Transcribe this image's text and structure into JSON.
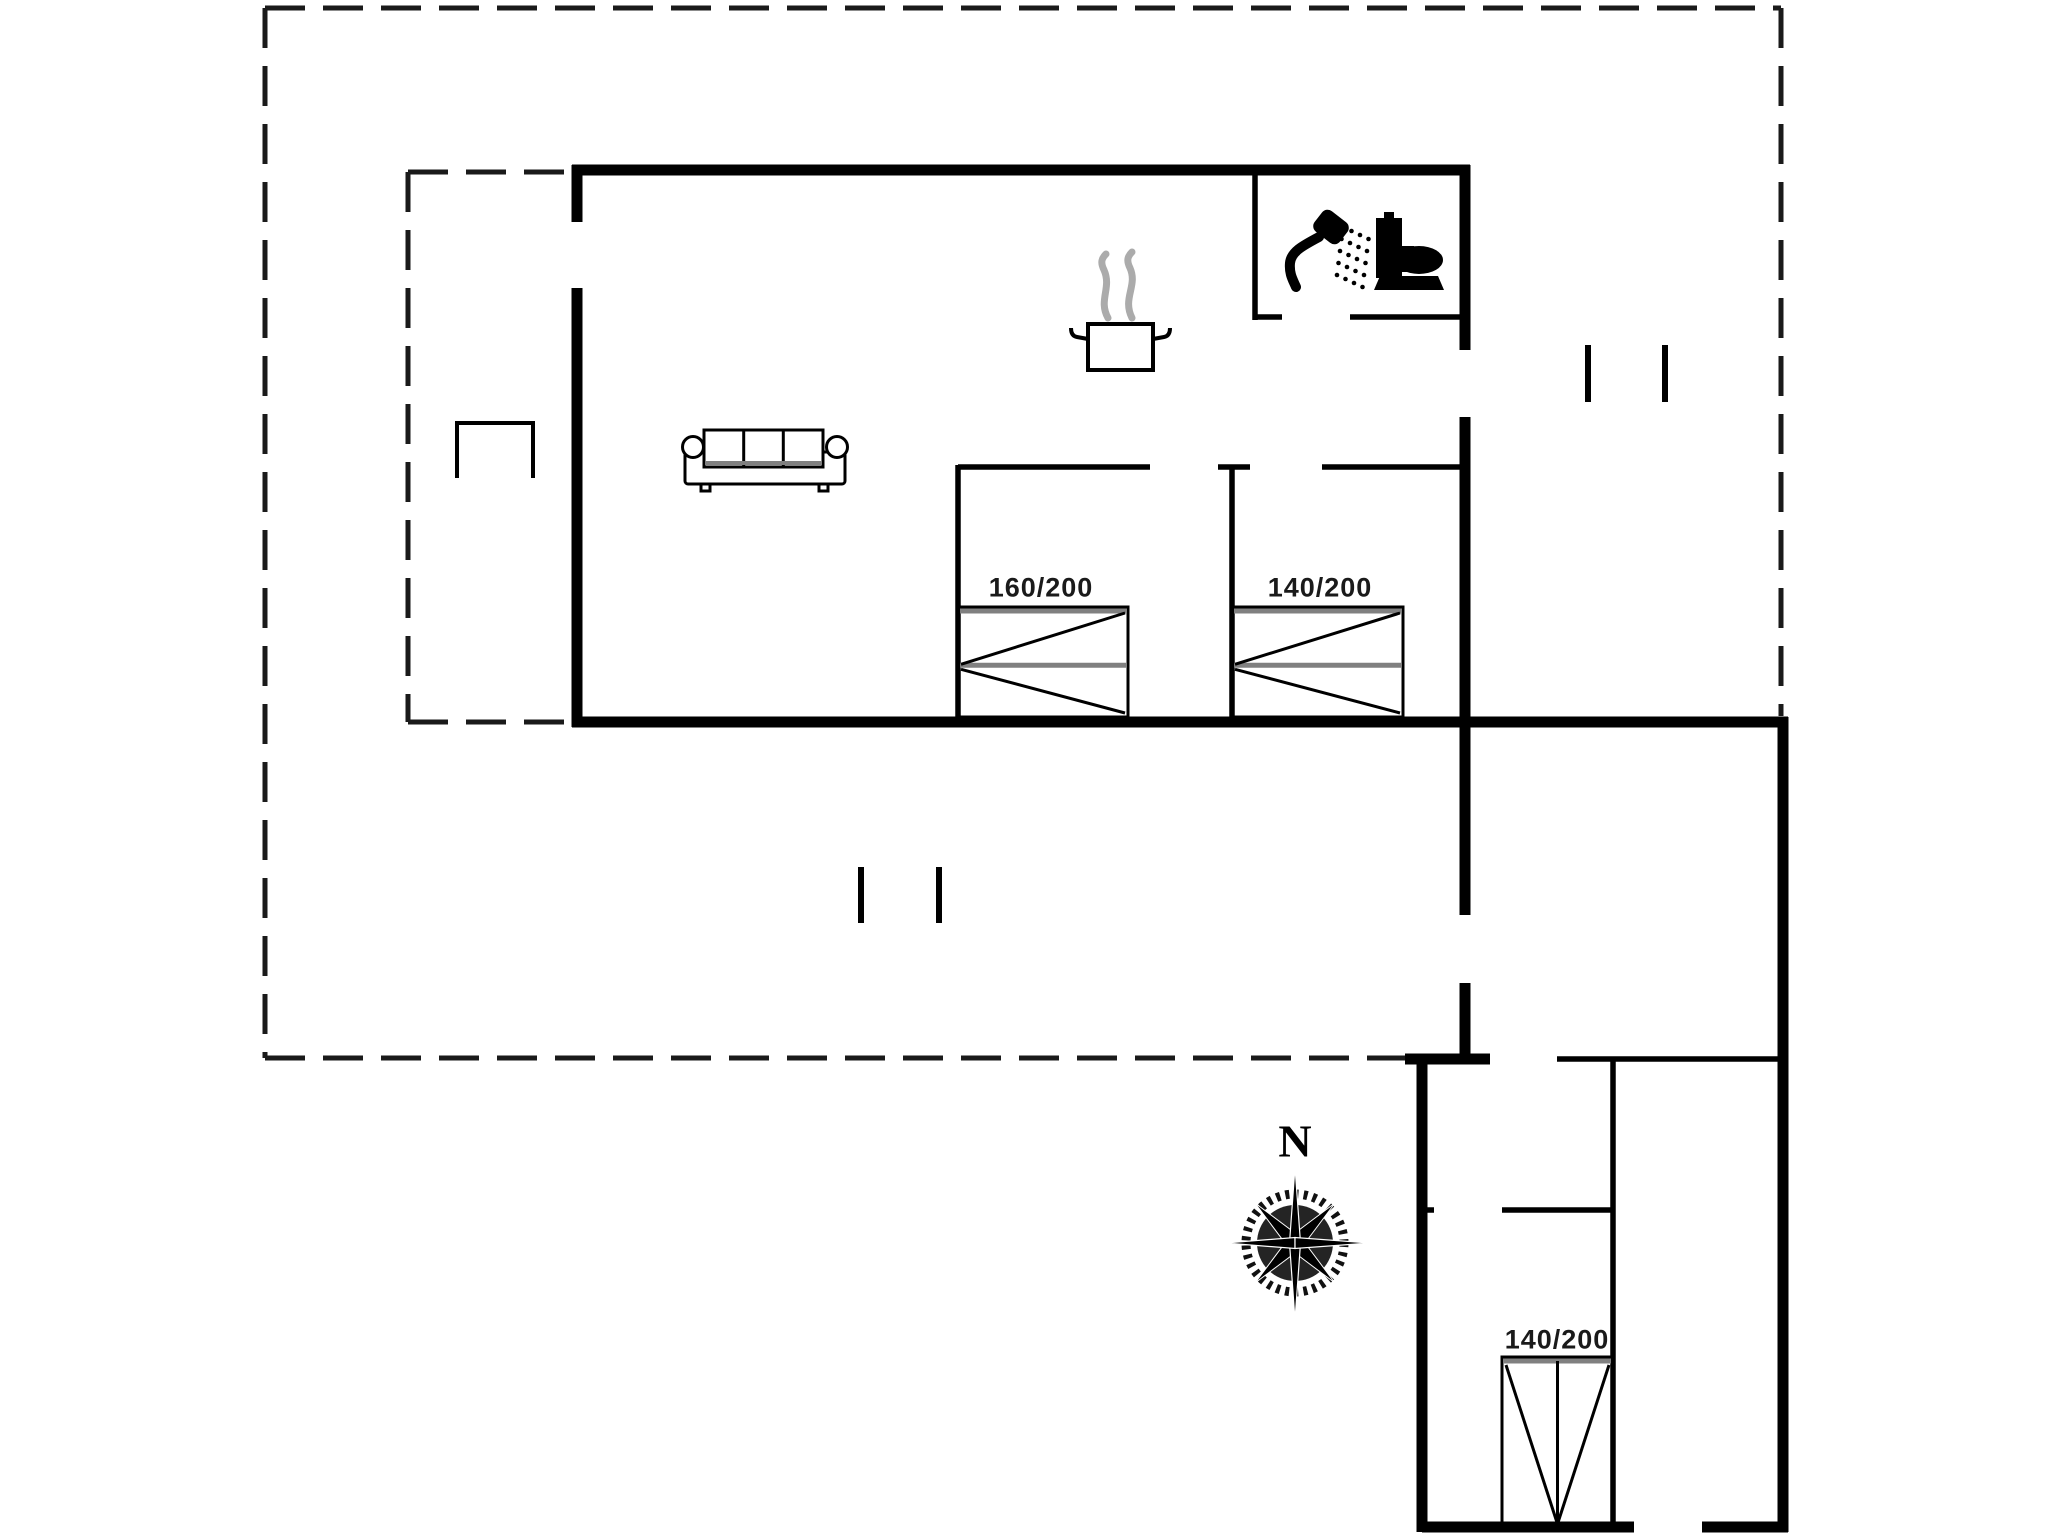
{
  "page": {
    "background": "#ffffff",
    "width": 2048,
    "height": 1536
  },
  "colors": {
    "wall": "#000000",
    "partition": "#000000",
    "boundary": "#1a1a1a",
    "bed_gray": "#808080",
    "steam": "#ababab",
    "icon": "#000000",
    "label_text": "#1a1a1a"
  },
  "floorplan": {
    "outer_boundary_dashed": [
      [
        265,
        8,
        1781,
        8
      ],
      [
        265,
        8,
        265,
        1058
      ],
      [
        265,
        1058,
        1408,
        1058
      ],
      [
        1781,
        8,
        1781,
        716
      ]
    ],
    "inner_terrace_dashed": [
      [
        408,
        172,
        570,
        172
      ],
      [
        408,
        172,
        408,
        722
      ],
      [
        408,
        722,
        574,
        722
      ]
    ],
    "walls_thick": [
      [
        572,
        170,
        1470,
        170
      ],
      [
        577,
        165,
        577,
        222
      ],
      [
        577,
        288,
        577,
        727
      ],
      [
        572,
        722,
        1788,
        722
      ],
      [
        1465,
        165,
        1465,
        350
      ],
      [
        1465,
        417,
        1465,
        915
      ],
      [
        1465,
        983,
        1465,
        1064
      ],
      [
        1783,
        717,
        1783,
        1532
      ],
      [
        1422,
        1054,
        1422,
        1532
      ],
      [
        1405,
        1059,
        1490,
        1059
      ],
      [
        1422,
        1527,
        1634,
        1527
      ],
      [
        1702,
        1527,
        1788,
        1527
      ]
    ],
    "walls_thin": [
      [
        1255,
        170,
        1255,
        320
      ],
      [
        1255,
        317,
        1282,
        317
      ],
      [
        1350,
        317,
        1468,
        317
      ],
      [
        958,
        465,
        958,
        724
      ],
      [
        958,
        467,
        1150,
        467
      ],
      [
        1232,
        465,
        1232,
        724
      ],
      [
        1218,
        467,
        1250,
        467
      ],
      [
        1322,
        467,
        1468,
        467
      ],
      [
        1613,
        1059,
        1613,
        1529
      ],
      [
        1422,
        1210,
        1434,
        1210
      ],
      [
        1502,
        1210,
        1613,
        1210
      ],
      [
        1557,
        1059,
        1786,
        1059
      ]
    ],
    "window_markers": [
      [
        861,
        867,
        861,
        923
      ],
      [
        939,
        867,
        939,
        923
      ],
      [
        1588,
        345,
        1588,
        402
      ],
      [
        1665,
        345,
        1665,
        402
      ]
    ],
    "beds": [
      {
        "label": "160/200",
        "x": 958,
        "y": 607,
        "w": 170,
        "h": 110,
        "dir": "left",
        "label_x": 1041,
        "label_y": 588
      },
      {
        "label": "140/200",
        "x": 1232,
        "y": 607,
        "w": 171,
        "h": 110,
        "dir": "left",
        "label_x": 1320,
        "label_y": 588
      },
      {
        "label": "140/200",
        "x": 1502,
        "y": 1357,
        "w": 111,
        "h": 170,
        "dir": "down",
        "label_x": 1557,
        "label_y": 1340
      }
    ],
    "sofa": {
      "x": 680,
      "y": 428,
      "w": 170,
      "h": 64
    },
    "table": {
      "x": 455,
      "y": 421,
      "w": 80,
      "h": 57
    },
    "pot": {
      "x": 1088,
      "y": 324,
      "w": 65,
      "h": 46
    },
    "shower": {
      "cx": 1322,
      "cy": 250
    },
    "toilet": {
      "x": 1376,
      "y": 212
    },
    "compass": {
      "cx": 1295,
      "cy": 1243,
      "r": 52,
      "label": "N",
      "label_x": 1295,
      "label_y": 1141
    }
  }
}
